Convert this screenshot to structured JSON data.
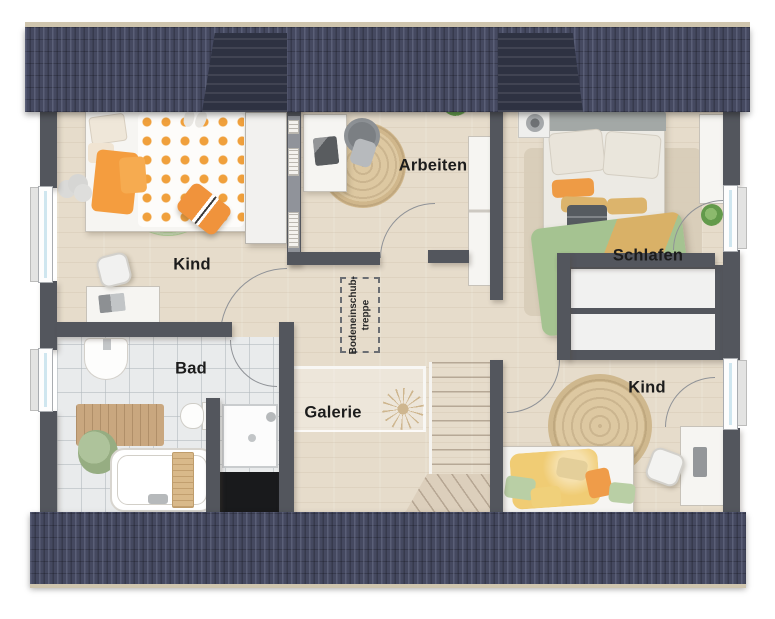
{
  "palette": {
    "roof": "#454960",
    "roof-dark": "#2e3242",
    "wall": "#53565d",
    "floor": "#e6dccb",
    "tile": "#e9ebec",
    "glass": "#cfe6ef",
    "rug-green": "#bcd6a5",
    "rug-jute": "#d9c29a",
    "accent-orange": "#f09a3e",
    "accent-green": "#a6c492",
    "accent-tan": "#dcb46c"
  },
  "rooms": [
    {
      "id": "kind-left",
      "label": "Kind"
    },
    {
      "id": "arbeiten",
      "label": "Arbeiten"
    },
    {
      "id": "schlafen",
      "label": "Schlafen"
    },
    {
      "id": "bad",
      "label": "Bad"
    },
    {
      "id": "galerie",
      "label": "Galerie"
    },
    {
      "id": "kind-right",
      "label": "Kind"
    }
  ],
  "loft_hatch": {
    "line1": "Bodeneinschub-",
    "line2": "treppe"
  }
}
